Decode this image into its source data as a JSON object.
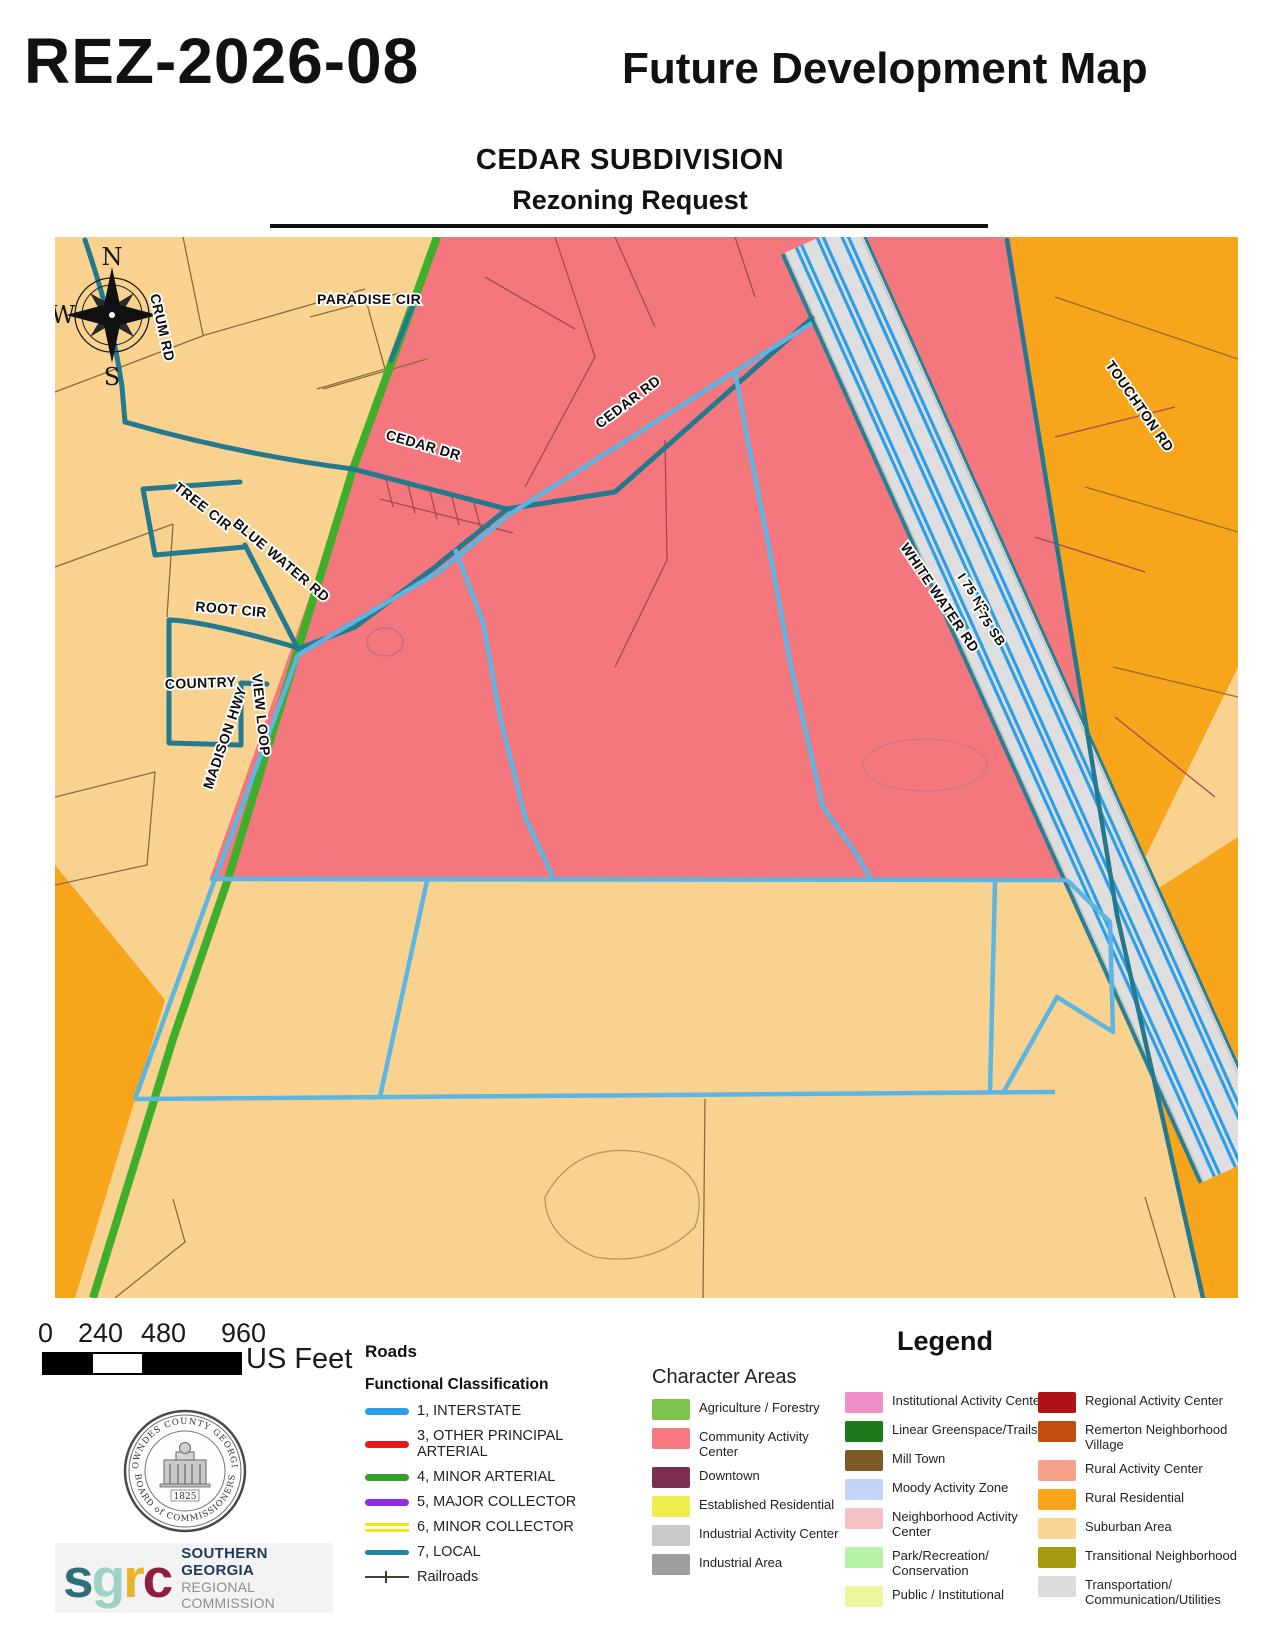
{
  "header": {
    "case_number": "REZ-2026-08",
    "map_title": "Future Development Map",
    "subtitle_line1": "CEDAR SUBDIVISION",
    "subtitle_line2": "Rezoning Request"
  },
  "map": {
    "compass": {
      "north": "N",
      "south": "S",
      "west": "W"
    },
    "road_labels": {
      "paradise": "PARADISE CIR",
      "crum": "CRUM RD",
      "cedar_dr": "CEDAR DR",
      "cedar_rd": "CEDAR RD",
      "tree_cir": "TREE CIR",
      "blue_water": "BLUE WATER RD",
      "root_cir": "ROOT CIR",
      "country": "COUNTRY",
      "view_loop": "VIEW LOOP",
      "madison": "MADISON HWY",
      "white_water": "WHITE WATER RD",
      "i75_nb": "I 75 NB",
      "i75_sb": "I 75 SB",
      "touchton": "TOUCHTON RD"
    }
  },
  "map_colors": {
    "suburban_tan": "#F8D28E",
    "community_pink": "#F4777E",
    "rural_orange": "#F7A51B",
    "minor_arterial_green": "#3FAE2A",
    "local_road_teal": "#23798E",
    "interstate_blue": "#2D9FE8",
    "subject_outline_blue": "#5CB5E2",
    "highway_band_gray": "#DEDEDE"
  },
  "scale_bar": {
    "ticks": [
      "0",
      "240",
      "480",
      "960"
    ],
    "unit": "US Feet"
  },
  "roads_legend": {
    "title": "Roads",
    "subtitle": "Functional Classification",
    "items": [
      {
        "label": "1, INTERSTATE",
        "color": "#2D9FE8"
      },
      {
        "label": "3, OTHER PRINCIPAL ARTERIAL",
        "color": "#E31A1C"
      },
      {
        "label": "4, MINOR ARTERIAL",
        "color": "#33A02C"
      },
      {
        "label": "5, MAJOR COLLECTOR",
        "color": "#8F2BE0"
      },
      {
        "label": "6, MINOR COLLECTOR",
        "color": "#F2E70E"
      },
      {
        "label": "7, LOCAL",
        "color": "#1F87A0"
      }
    ],
    "railroads_label": "Railroads"
  },
  "character_areas": {
    "legend_title": "Legend",
    "title": "Character Areas",
    "columns": [
      [
        {
          "label": "Agriculture / Forestry",
          "color": "#7DC44F"
        },
        {
          "label": "Community Activity Center",
          "color": "#F5797F"
        },
        {
          "label": "Downtown",
          "color": "#7D2D52"
        },
        {
          "label": "Established Residential",
          "color": "#EDED4E"
        },
        {
          "label": "Industrial Activity Center",
          "color": "#C9C9C9"
        },
        {
          "label": "Industrial Area",
          "color": "#9E9E9E"
        }
      ],
      [
        {
          "label": "Institutional Activity Center",
          "color": "#EF8FC7"
        },
        {
          "label": "Linear Greenspace/Trails",
          "color": "#1E7A1E"
        },
        {
          "label": "Mill Town",
          "color": "#7D5B28"
        },
        {
          "label": "Moody Activity Zone",
          "color": "#C3D3F7"
        },
        {
          "label": "Neighborhood Activity Center",
          "color": "#F6C1C4"
        },
        {
          "label": "Park/Recreation/ Conservation",
          "color": "#B5F3A5"
        },
        {
          "label": "Public / Institutional",
          "color": "#EEF7A0"
        }
      ],
      [
        {
          "label": "Regional Activity Center",
          "color": "#B01217"
        },
        {
          "label": "Remerton Neighborhood Village",
          "color": "#C14E0F"
        },
        {
          "label": "Rural Activity Center",
          "color": "#F7A289"
        },
        {
          "label": "Rural Residential",
          "color": "#F9A61B"
        },
        {
          "label": "Suburban Area",
          "color": "#F9D595"
        },
        {
          "label": "Transitional Neighborhood",
          "color": "#A79A0E"
        },
        {
          "label": "Transportation/ Communication/Utilities",
          "color": "#DCDCDC"
        }
      ]
    ]
  },
  "logos": {
    "seal": {
      "top_text": "LOWNDES COUNTY GEORGIA",
      "bottom_text": "BOARD of COMMISSIONERS",
      "year": "1825"
    },
    "sgrc": {
      "letters": [
        {
          "char": "s",
          "color": "#2F6F78"
        },
        {
          "char": "g",
          "color": "#9ED2C6"
        },
        {
          "char": "r",
          "color": "#E9B32A"
        },
        {
          "char": "c",
          "color": "#8F1D3F"
        }
      ],
      "name_line1": "SOUTHERN GEORGIA",
      "name_line2": "REGIONAL COMMISSION"
    }
  }
}
